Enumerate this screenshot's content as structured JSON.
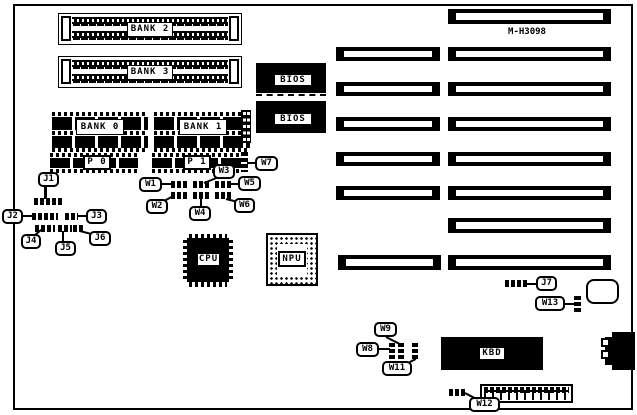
{
  "board": {
    "id_label": "M-H3098",
    "foreground_color": "#000000",
    "background_color": "#ffffff"
  },
  "memory": {
    "bank2": "BANK 2",
    "bank3": "BANK 3",
    "bank0": "BANK 0",
    "bank1": "BANK 1",
    "p0": "P 0",
    "p1": "P 1"
  },
  "chips": {
    "bios": "BIOS",
    "cpu": "CPU",
    "npu": "NPU",
    "kbd": "KBD"
  },
  "jumpers": {
    "j1": "J1",
    "j2": "J2",
    "j3": "J3",
    "j4": "J4",
    "j5": "J5",
    "j6": "J6",
    "j7": "J7",
    "w1": "W1",
    "w2": "W2",
    "w3": "W3",
    "w4": "W4",
    "w5": "W5",
    "w6": "W6",
    "w7": "W7",
    "w8": "W8",
    "w9": "W9",
    "w11": "W11",
    "w12": "W12",
    "w13": "W13"
  }
}
